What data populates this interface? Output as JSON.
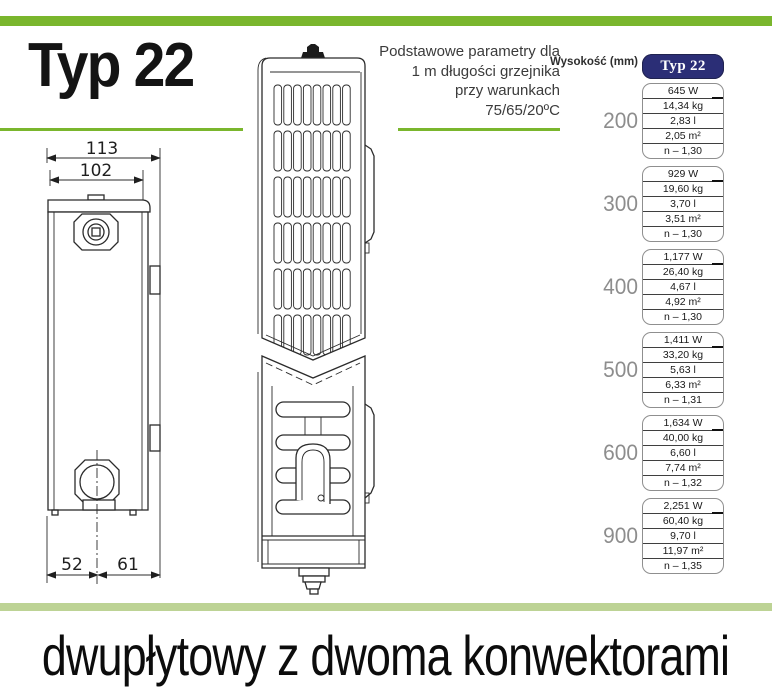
{
  "page": {
    "title": "Typ 22",
    "caption": "dwupłytowy z dwoma konwektorami",
    "params_note_lines": [
      "Podstawowe parametry dla",
      "1 m długości grzejnika",
      "przy warunkach",
      "75/65/20ºC"
    ]
  },
  "colors": {
    "accent_green": "#7ab62d",
    "pale_green": "#bdd395",
    "navy": "#2b2e76",
    "height_label_gray": "#8d8d8d"
  },
  "table": {
    "height_label": "Wysokość (mm)",
    "column_header": "Typ 22",
    "rows": [
      {
        "height": "200",
        "values": [
          "645 W",
          "14,34 kg",
          "2,83 l",
          "2,05 m²",
          "n – 1,30"
        ]
      },
      {
        "height": "300",
        "values": [
          "929 W",
          "19,60 kg",
          "3,70 l",
          "3,51 m²",
          "n – 1,30"
        ]
      },
      {
        "height": "400",
        "values": [
          "1,177 W",
          "26,40 kg",
          "4,67 l",
          "4,92 m²",
          "n – 1,30"
        ]
      },
      {
        "height": "500",
        "values": [
          "1,411 W",
          "33,20 kg",
          "5,63 l",
          "6,33 m²",
          "n – 1,31"
        ]
      },
      {
        "height": "600",
        "values": [
          "1,634 W",
          "40,00 kg",
          "6,60 l",
          "7,74 m²",
          "n – 1,32"
        ]
      },
      {
        "height": "900",
        "values": [
          "2,251 W",
          "60,40 kg",
          "9,70 l",
          "11,97 m²",
          "n – 1,35"
        ]
      }
    ]
  },
  "drawing": {
    "dim_top_outer": "113",
    "dim_top_inner": "102",
    "dim_bottom_left": "52",
    "dim_bottom_right": "61"
  }
}
